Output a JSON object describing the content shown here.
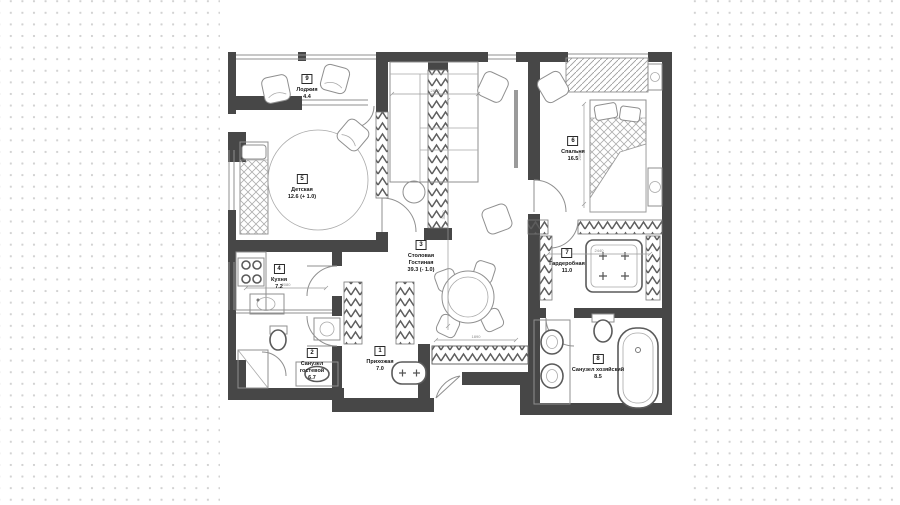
{
  "page": {
    "type": "apartment floor plan drawing",
    "language": "ru"
  },
  "canvas": {
    "paper_color": "#ffffff",
    "dot_color": "#d2d2d2",
    "wall_color": "#474747",
    "line_color": "#8f8f8f"
  },
  "plan": {
    "rooms": [
      {
        "number": "1",
        "name": "Прихожая",
        "area": "7.0"
      },
      {
        "number": "2",
        "name": "Санузел\nгостевой",
        "area": "6.7"
      },
      {
        "number": "3",
        "name": "Столовая\nГостиная",
        "area": "39.3 (- 1.0)"
      },
      {
        "number": "4",
        "name": "Кухня",
        "area": "7.2"
      },
      {
        "number": "5",
        "name": "Детская",
        "area": "12.6 (+ 1.0)"
      },
      {
        "number": "6",
        "name": "Спальня",
        "area": "16.5"
      },
      {
        "number": "7",
        "name": "Гардеробная",
        "area": "11.0"
      },
      {
        "number": "8",
        "name": "Санузел хозяйский",
        "area": "8.5"
      },
      {
        "number": "9",
        "name": "Лоджия",
        "area": "4.4"
      }
    ],
    "dimensions": [
      {
        "value": "2890"
      },
      {
        "value": "3050"
      },
      {
        "value": "2060"
      },
      {
        "value": "2080"
      },
      {
        "value": "2440"
      },
      {
        "value": "1890"
      }
    ]
  }
}
